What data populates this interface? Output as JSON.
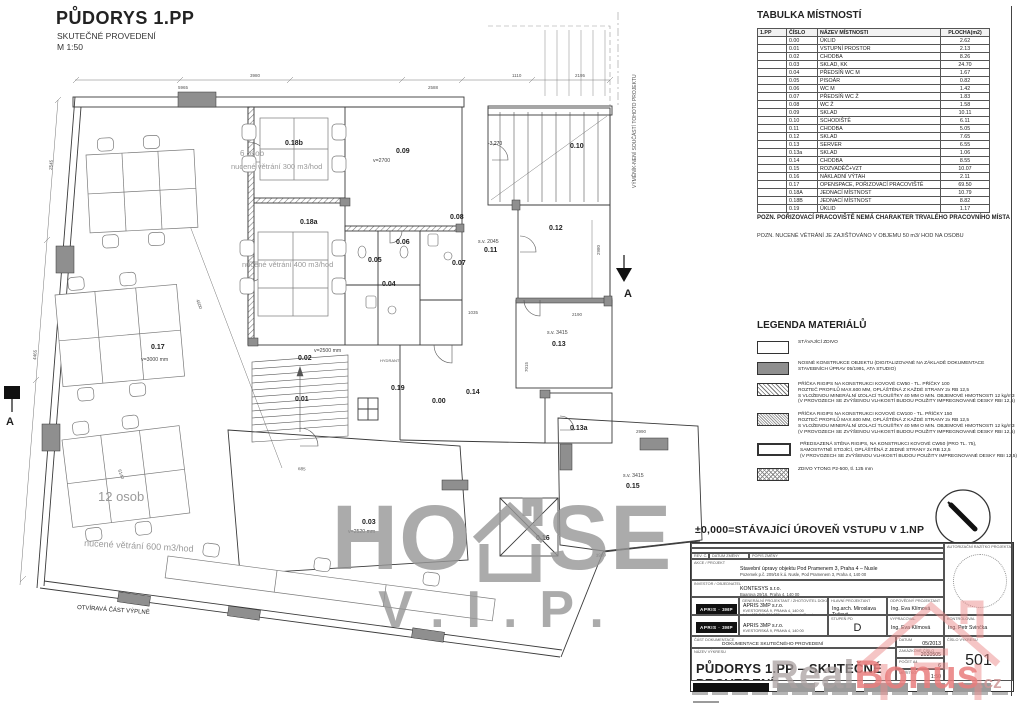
{
  "header": {
    "title": "PŮDORYS 1.PP",
    "subtitle": "SKUTEČNÉ PROVEDENÍ",
    "scale": "M 1:50"
  },
  "room_table": {
    "title": "TABULKA MÍSTNOSTÍ",
    "columns": [
      "1.PP",
      "ČÍSLO",
      "NÁZEV MÍSTNOSTI",
      "PLOCHA(m2)"
    ],
    "rows": [
      [
        "0.00",
        "ÚKLID",
        "2.62"
      ],
      [
        "0.01",
        "VSTUPNÍ PROSTOR",
        "2.13"
      ],
      [
        "0.02",
        "CHODBA",
        "8.26"
      ],
      [
        "0.03",
        "SKLAD, KK",
        "24.70"
      ],
      [
        "0.04",
        "PŘEDSÍŇ WC M",
        "1.67"
      ],
      [
        "0.05",
        "PISOÁR",
        "0.82"
      ],
      [
        "0.06",
        "WC M",
        "1.42"
      ],
      [
        "0.07",
        "PŘEDSÍŇ WC Ž",
        "1.83"
      ],
      [
        "0.08",
        "WC Ž",
        "1.58"
      ],
      [
        "0.09",
        "SKLAD",
        "10.11"
      ],
      [
        "0.10",
        "SCHODIŠTĚ",
        "6.11"
      ],
      [
        "0.11",
        "CHODBA",
        "5.05"
      ],
      [
        "0.12",
        "SKLAD",
        "7.65"
      ],
      [
        "0.13",
        "SERVER",
        "6.55"
      ],
      [
        "0.13a",
        "SKLAD",
        "1.06"
      ],
      [
        "0.14",
        "CHODBA",
        "8.55"
      ],
      [
        "0.15",
        "ROZVADĚČ+VZT",
        "10.07"
      ],
      [
        "0.16",
        "NÁKLADNÍ VÝTAH",
        "2.11"
      ],
      [
        "0.17",
        "OPENSPACE, POŘIZOVACÍ PRACOVIŠTĚ",
        "69.50"
      ],
      [
        "0.18A",
        "JEDNACÍ MÍSTNOST",
        "10.79"
      ],
      [
        "0.18B",
        "JEDNACÍ MÍSTNOST",
        "8.82"
      ],
      [
        "0.19",
        "ÚKLID",
        "1.17"
      ]
    ]
  },
  "notes": {
    "note1": "POZN. POŘIZOVACÍ PRACOVIŠTĚ NEMÁ CHARAKTER TRVALÉHO PRACOVNÍHO MÍSTA",
    "note2": "POZN. NUCENÉ VĚTRÁNÍ JE ZAJIŠŤOVÁNO V OBJEMU 50 m3/ HOD NA OSOBU"
  },
  "legend": {
    "title": "LEGENDA MATERIÁLŮ",
    "items": [
      {
        "swatch": "white",
        "lines": [
          "STÁVAJÍCÍ ZDIVO"
        ]
      },
      {
        "swatch": "gray",
        "lines": [
          "NOSNÉ KONSTRUKCE OBJEKTU (DIGITALIZOVANÉ NA ZÁKLADĚ DOKUMENTACE",
          "STAVEBNÍCH ÚPRAV 05/1991, ATA STUDIO)"
        ]
      },
      {
        "swatch": "hatch",
        "lines": [
          "PŘÍČKA RIGIPS NA KONSTRUKCI KOVOVÉ CW50 - TL. PŘÍČKY 100",
          "ROZTEČ PROFILŮ MAX.600 MM, OPLÁŠTĚNÁ Z KAŽDÉ STRANY 2x RB 12,5",
          "S VLOŽENOU MINERÁLNÍ IZOLACÍ TLOUŠŤKY 40 MM O MIN. OBJEMOVÉ HMOTNOSTI 12 kg/m3",
          "(V PROVOZECH SE ZVÝŠENOU VLHKOSTÍ BUDOU POUŽITY IMPREGNOVANÉ DESKY RBI 12,5)"
        ]
      },
      {
        "swatch": "dense",
        "lines": [
          "PŘÍČKA RIGIPS NA KONSTRUKCI KOVOVÉ CW100 - TL. PŘÍČKY 150",
          "ROZTEČ PROFILŮ MAX.600 MM, OPLÁŠTĚNÁ Z KAŽDÉ STRANY 2x RB 12,5",
          "S VLOŽENOU MINERÁLNÍ IZOLACÍ TLOUŠŤKY 40 MM O MIN. OBJEMOVÉ HMOTNOSTI 12 kg/m3",
          "(V PROVOZECH SE ZVÝŠENOU VLHKOSTÍ BUDOU POUŽITY IMPREGNOVANÉ DESKY RBI 12,5)"
        ]
      },
      {
        "swatch": "thick",
        "lines": [
          "PŘEDSAZENÁ STĚNA RIGIPS, NA KONSTRUKCI KOVOVÉ CW50 (PRO TL. 75),",
          "SAMOSTATNĚ STOJÍCÍ, OPLÁŠTĚNÁ Z JEDNÉ STRANY 2x RB 12,5",
          "(V PROVOZECH SE ZVÝŠENOU VLHKOSTÍ BUDOU POUŽITY IMPREGNOVANÉ DESKY RBI 12,5)"
        ]
      },
      {
        "swatch": "cross",
        "lines": [
          "ZDIVO YTONG P2-500, tl. 125 mm"
        ]
      }
    ]
  },
  "datum_note": "±0,000=STÁVAJÍCÍ ÚROVEŇ VSTUPU V 1.NP",
  "titleblock": {
    "rev_headers": {
      "a": "REV. Č.",
      "b": "DATUM ZMĚNY",
      "c": "POPIS ZMĚNY"
    },
    "project_label": "AKCE / PROJEKT",
    "project_line1": "Stavební úpravy objektu Pod Pramenem 3, Praha 4 – Nusle",
    "project_line2": "Pozemek p.č. 209/16 k.ú. Nusle, Pod Pramenem 3, Praha 4, 140 00",
    "investor_label": "INVESTOR / OBJEDNATEL",
    "investor_line1": "KONTESYS s.r.o.",
    "investor_line2": "Baarova 29/16, Praha 4, 140 00",
    "designer_label": "GENERÁLNÍ PROJEKTANT / ZHOTOVITEL DOKUMENTACE",
    "designer_logo": "APRIS · 3MP",
    "designer_line1": "APRIS 3MP s.r.o.",
    "designer_line2": "KVESTORSKÁ 9, PRAHA 4, 140 00",
    "designer_line3": "tel: +420 241 091 230, e-mail: apris@apris.cz",
    "chief_label": "HLAVNÍ PROJEKTANT",
    "chief_name": "Ing.arch. Miroslava Tyčová",
    "responsible_label": "ODPOVĚDNÝ PROJEKTANT",
    "responsible_name": "Ing. Eva Klímová",
    "stage_label": "STUPEŇ PD",
    "stage_value": "D",
    "drafted_label": "VYPRACOVAL",
    "drafted_name": "Ing. Eva Klímová",
    "checked_label": "KONTROLOVAL",
    "checked_name": "Ing. Petr Svinčka",
    "doc_part_label": "ČÁST DOKUMENTACE",
    "doc_part": "DOKUMENTACE SKUTEČNÉHO PROVEDENÍ",
    "drawing_label": "NÁZEV VÝKRESU",
    "drawing_title": "PŮDORYS 1.PP – SKUTEČNÉ PROVEDENÍ",
    "date_label": "DATUM",
    "date": "05/2013",
    "order_label": "ZAKÁZKOVÉ ČÍSLO",
    "order_number": "2020505",
    "format_label": "POČET A4",
    "format": "6",
    "scale_label": "MĚŘÍTKO",
    "scale": "1:50",
    "number_label": "ČÍSLO VÝKRESU",
    "number": "501",
    "stamp_label": "AUTORIZAČNÍ RAZÍTKO PROJEKTANTA"
  },
  "watermarks": {
    "house_prefix": "HO",
    "house_suffix": "SE",
    "vip": "V.I.P.",
    "real": "Real",
    "bonus": "Bonus",
    "cz": ".cz"
  },
  "plan": {
    "rooms": [
      {
        "id": "0.17",
        "x": 151,
        "y": 349,
        "sub": "v=3000 mm",
        "sx": 141,
        "sy": 361
      },
      {
        "id": "0.18b",
        "x": 285,
        "y": 145
      },
      {
        "id": "0.18a",
        "x": 300,
        "y": 224
      },
      {
        "id": "0.09",
        "x": 396,
        "y": 153,
        "sub": "v=2700",
        "sx": 373,
        "sy": 162
      },
      {
        "id": "0.10",
        "x": 570,
        "y": 148
      },
      {
        "id": "0.12",
        "x": 549,
        "y": 230
      },
      {
        "id": "0.11",
        "x": 484,
        "y": 252,
        "sub": "s.v. 2045",
        "sx": 478,
        "sy": 243
      },
      {
        "id": "0.08",
        "x": 450,
        "y": 219
      },
      {
        "id": "0.06",
        "x": 396,
        "y": 244
      },
      {
        "id": "0.05",
        "x": 368,
        "y": 262
      },
      {
        "id": "0.04",
        "x": 382,
        "y": 286
      },
      {
        "id": "0.07",
        "x": 452,
        "y": 265
      },
      {
        "id": "0.13",
        "x": 552,
        "y": 346,
        "sub": "s.v. 3415",
        "sx": 547,
        "sy": 334
      },
      {
        "id": "0.14",
        "x": 466,
        "y": 394
      },
      {
        "id": "0.19",
        "x": 391,
        "y": 390
      },
      {
        "id": "0.00",
        "x": 432,
        "y": 403
      },
      {
        "id": "0.13a",
        "x": 570,
        "y": 430
      },
      {
        "id": "0.15",
        "x": 626,
        "y": 488,
        "sub": "s.v. 3415",
        "sx": 623,
        "sy": 477
      },
      {
        "id": "0.16",
        "x": 536,
        "y": 540
      },
      {
        "id": "0.03",
        "x": 362,
        "y": 524,
        "sub": "v=2520 mm",
        "sx": 348,
        "sy": 533
      },
      {
        "id": "0.02",
        "x": 298,
        "y": 360,
        "sub": "v=2500 mm",
        "sx": 314,
        "sy": 352
      },
      {
        "id": "0.01",
        "x": 295,
        "y": 401
      }
    ],
    "annotations": [
      {
        "t": "12 osob",
        "x": 98,
        "y": 501,
        "size": 13,
        "color": "#9a9a9a"
      },
      {
        "t": "nucené větrání 600 m3/hod",
        "x": 84,
        "y": 546,
        "size": 9,
        "color": "#9a9a9a",
        "r": 3
      },
      {
        "t": "6 osob",
        "x": 240,
        "y": 156,
        "size": 8,
        "color": "#9a9a9a"
      },
      {
        "t": "nucené větrání 300 m3/hod",
        "x": 231,
        "y": 169,
        "size": 7.5,
        "color": "#9a9a9a"
      },
      {
        "t": "nucené větrání 400 m3/hod",
        "x": 242,
        "y": 267,
        "size": 7.5,
        "color": "#9a9a9a"
      },
      {
        "t": "OTVÍRAVÁ ČÁST VÝPLNĚ",
        "x": 77,
        "y": 609,
        "size": 6,
        "r": 4
      },
      {
        "t": "VÝMĚNÍK-NENÍ SOUČÁSTÍ TOHOTO PROJEKTU",
        "x": 636,
        "y": 188,
        "size": 5,
        "r": -90,
        "color": "#555"
      },
      {
        "t": "-3,270",
        "x": 488,
        "y": 145,
        "size": 5
      },
      {
        "t": "HYDRANT",
        "x": 380,
        "y": 362,
        "size": 4,
        "color": "#555"
      },
      {
        "t": "A",
        "x": 6,
        "y": 425,
        "size": 11,
        "bold": true
      },
      {
        "t": "A",
        "x": 624,
        "y": 297,
        "size": 11,
        "bold": true
      }
    ],
    "dims": [
      {
        "t": "3980",
        "x": 250,
        "y": 77,
        "size": 4.5
      },
      {
        "t": "1110",
        "x": 512,
        "y": 77,
        "size": 4.5
      },
      {
        "t": "2195",
        "x": 575,
        "y": 77,
        "size": 4.5
      },
      {
        "t": "5965",
        "x": 178,
        "y": 89,
        "size": 4.5
      },
      {
        "t": "2588",
        "x": 428,
        "y": 89,
        "size": 4.5
      },
      {
        "t": "4500",
        "x": 196,
        "y": 300,
        "size": 4.5,
        "r": 70
      },
      {
        "t": "6140",
        "x": 118,
        "y": 470,
        "size": 4.5,
        "r": 70
      },
      {
        "t": "2545",
        "x": 52,
        "y": 170,
        "size": 4.5,
        "r": -85
      },
      {
        "t": "4465",
        "x": 36,
        "y": 360,
        "size": 4.5,
        "r": -85
      },
      {
        "t": "2980",
        "x": 600,
        "y": 255,
        "size": 4.5,
        "r": -90
      },
      {
        "t": "2190",
        "x": 572,
        "y": 316,
        "size": 4.5
      },
      {
        "t": "7015",
        "x": 528,
        "y": 372,
        "size": 4.5,
        "r": -90
      },
      {
        "t": "3960",
        "x": 596,
        "y": 557,
        "size": 4.5,
        "r": -5
      },
      {
        "t": "1035",
        "x": 468,
        "y": 314,
        "size": 4.5
      },
      {
        "t": "2990",
        "x": 636,
        "y": 433,
        "size": 4.5
      },
      {
        "t": "685",
        "x": 298,
        "y": 470,
        "size": 4.5,
        "r": 4
      }
    ]
  }
}
